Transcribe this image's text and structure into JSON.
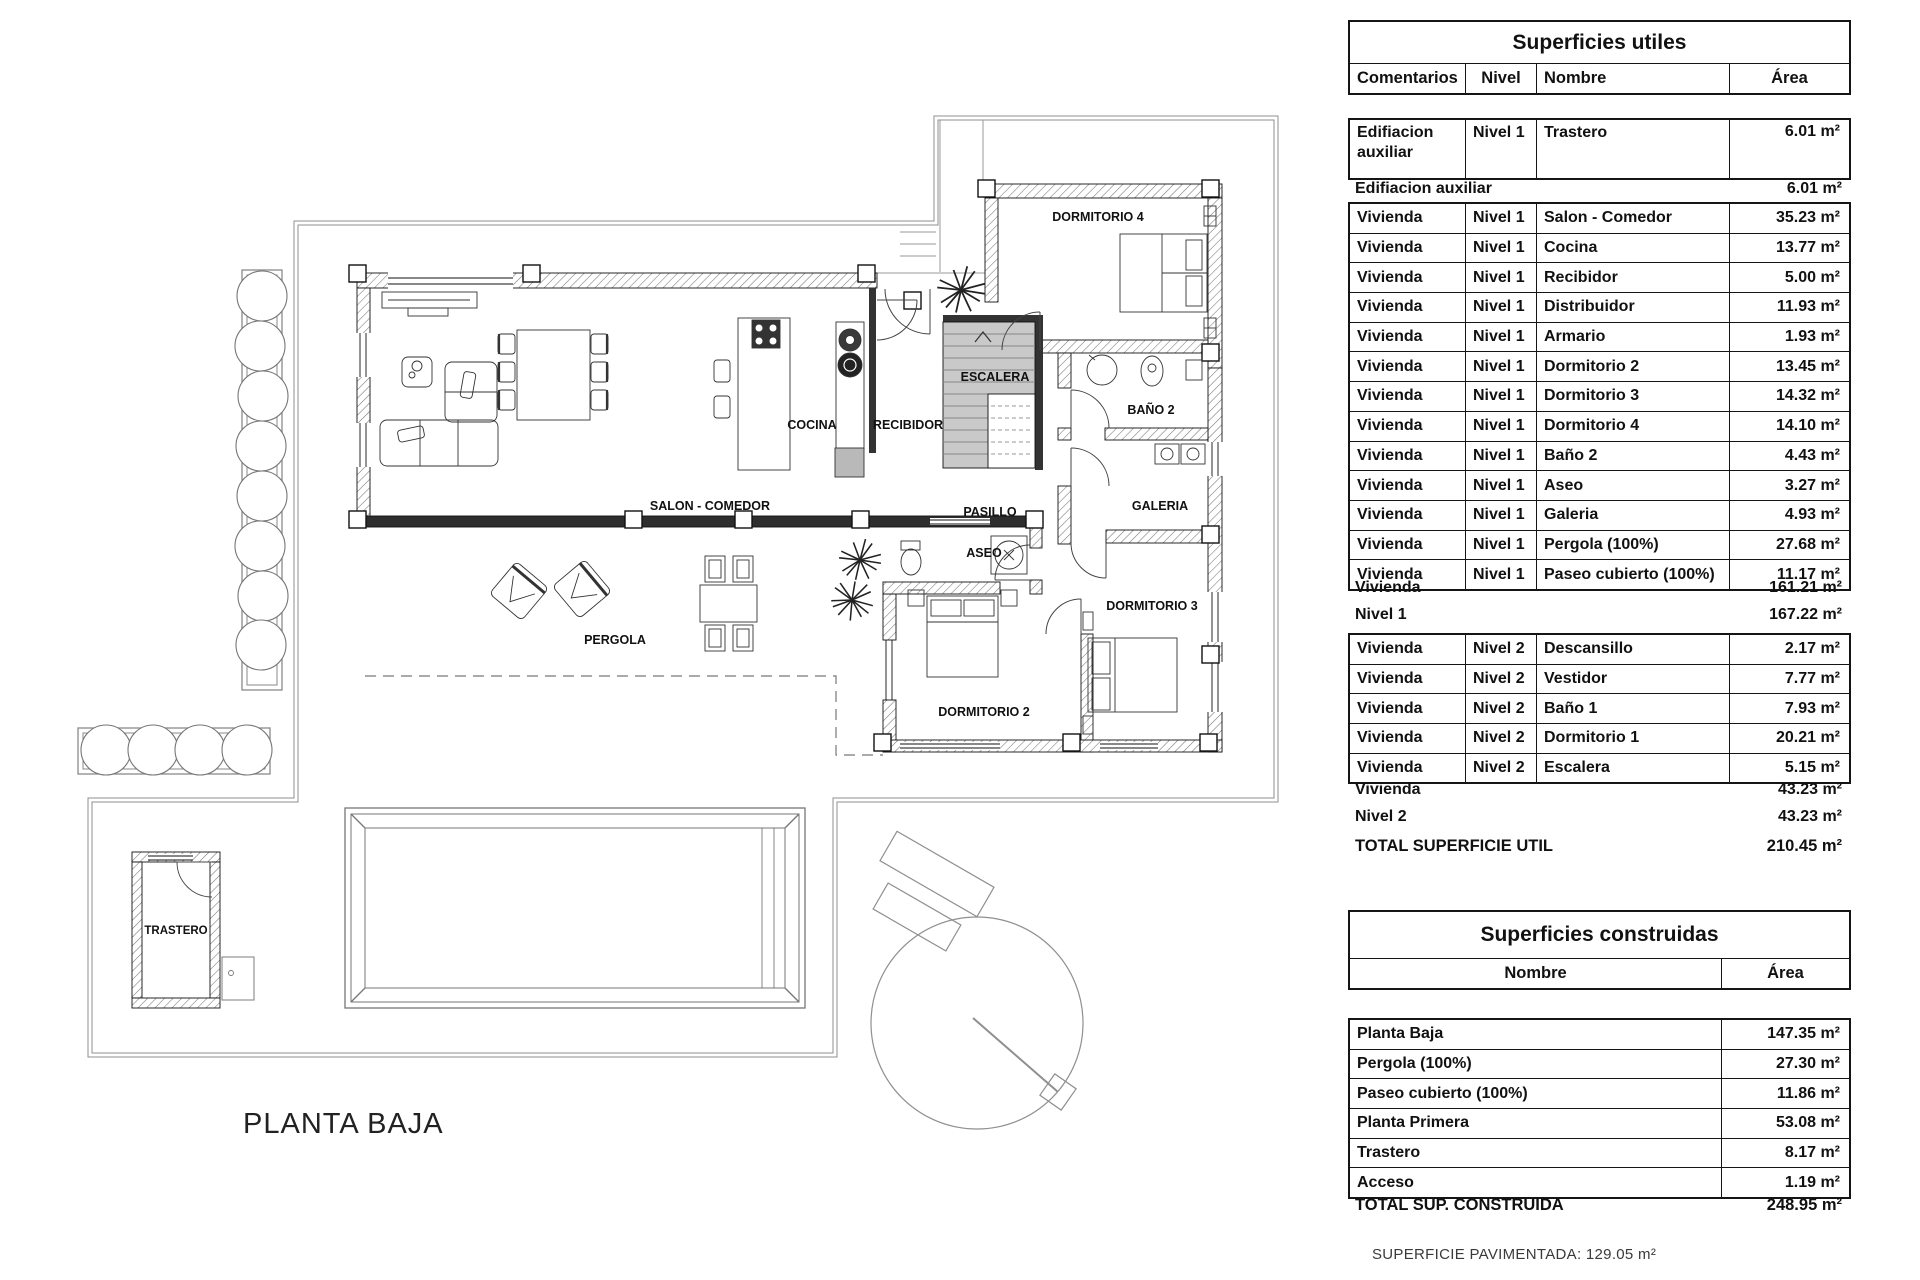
{
  "plan": {
    "title": "PLANTA BAJA",
    "rooms": {
      "salon": "SALON - COMEDOR",
      "cocina": "COCINA",
      "recibidor": "RECIBIDOR",
      "escalera": "ESCALERA",
      "pasillo": "PASILLO",
      "dormitorio4": "DORMITORIO 4",
      "bano2": "BAÑO 2",
      "galeria": "GALERIA",
      "aseo": "ASEO",
      "dormitorio2": "DORMITORIO 2",
      "dormitorio3": "DORMITORIO 3",
      "pergola": "PERGOLA",
      "trastero": "TRASTERO"
    }
  },
  "footnote": "SUPERFICIE PAVIMENTADA: 129.05 m²",
  "tables": {
    "utiles": {
      "title": "Superficies utiles",
      "headers": {
        "comentarios": "Comentarios",
        "nivel": "Nivel",
        "nombre": "Nombre",
        "area": "Área"
      },
      "rows": [
        {
          "c": "Edifiacion auxiliar",
          "l": "Nivel 1",
          "n": "Trastero",
          "a": "6.01 m²"
        },
        {
          "c": "Vivienda",
          "l": "Nivel 1",
          "n": "Salon - Comedor",
          "a": "35.23 m²"
        },
        {
          "c": "Vivienda",
          "l": "Nivel 1",
          "n": "Cocina",
          "a": "13.77 m²"
        },
        {
          "c": "Vivienda",
          "l": "Nivel 1",
          "n": "Recibidor",
          "a": "5.00 m²"
        },
        {
          "c": "Vivienda",
          "l": "Nivel 1",
          "n": "Distribuidor",
          "a": "11.93 m²"
        },
        {
          "c": "Vivienda",
          "l": "Nivel 1",
          "n": "Armario",
          "a": "1.93 m²"
        },
        {
          "c": "Vivienda",
          "l": "Nivel 1",
          "n": "Dormitorio 2",
          "a": "13.45 m²"
        },
        {
          "c": "Vivienda",
          "l": "Nivel 1",
          "n": "Dormitorio 3",
          "a": "14.32 m²"
        },
        {
          "c": "Vivienda",
          "l": "Nivel 1",
          "n": "Dormitorio 4",
          "a": "14.10 m²"
        },
        {
          "c": "Vivienda",
          "l": "Nivel 1",
          "n": "Baño 2",
          "a": "4.43 m²"
        },
        {
          "c": "Vivienda",
          "l": "Nivel 1",
          "n": "Aseo",
          "a": "3.27 m²"
        },
        {
          "c": "Vivienda",
          "l": "Nivel 1",
          "n": "Galeria",
          "a": "4.93 m²"
        },
        {
          "c": "Vivienda",
          "l": "Nivel 1",
          "n": "Pergola (100%)",
          "a": "27.68 m²"
        },
        {
          "c": "Vivienda",
          "l": "Nivel 1",
          "n": "Paseo cubierto (100%)",
          "a": "11.17 m²"
        },
        {
          "c": "Vivienda",
          "l": "Nivel 2",
          "n": "Descansillo",
          "a": "2.17 m²"
        },
        {
          "c": "Vivienda",
          "l": "Nivel 2",
          "n": "Vestidor",
          "a": "7.77 m²"
        },
        {
          "c": "Vivienda",
          "l": "Nivel 2",
          "n": "Baño 1",
          "a": "7.93 m²"
        },
        {
          "c": "Vivienda",
          "l": "Nivel 2",
          "n": "Dormitorio 1",
          "a": "20.21 m²"
        },
        {
          "c": "Vivienda",
          "l": "Nivel 2",
          "n": "Escalera",
          "a": "5.15 m²"
        }
      ],
      "subtotals": [
        {
          "label": "Edifiacion auxiliar",
          "area": "6.01 m²"
        },
        {
          "label": "Vivienda",
          "area": "161.21 m²"
        },
        {
          "label": "Nivel 1",
          "area": "167.22 m²"
        },
        {
          "label": "Vivienda",
          "area": "43.23 m²"
        },
        {
          "label": "Nivel 2",
          "area": "43.23 m²"
        }
      ],
      "total": {
        "label": "TOTAL SUPERFICIE UTIL",
        "area": "210.45 m²"
      }
    },
    "construidas": {
      "title": "Superficies construidas",
      "headers": {
        "nombre": "Nombre",
        "area": "Área"
      },
      "rows": [
        {
          "n": "Planta Baja",
          "a": "147.35 m²"
        },
        {
          "n": "Pergola (100%)",
          "a": "27.30 m²"
        },
        {
          "n": "Paseo cubierto (100%)",
          "a": "11.86 m²"
        },
        {
          "n": "Planta Primera",
          "a": "53.08 m²"
        },
        {
          "n": "Trastero",
          "a": "8.17 m²"
        },
        {
          "n": "Acceso",
          "a": "1.19 m²"
        }
      ],
      "total": {
        "label": "TOTAL SUP. CONSTRUIDA",
        "area": "248.95 m²"
      }
    }
  }
}
